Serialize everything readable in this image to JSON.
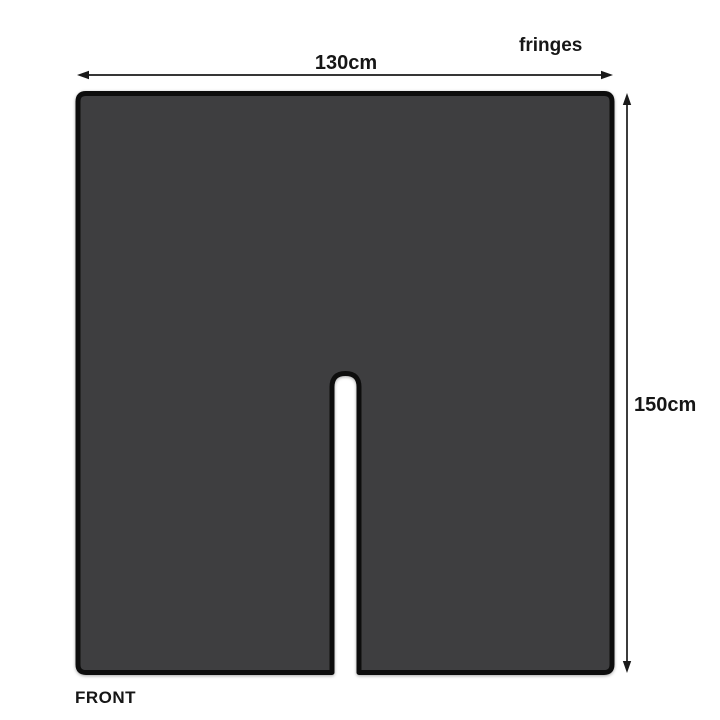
{
  "diagram": {
    "title": "fabric panel dimension diagram",
    "width_label": "130cm",
    "height_label": "150cm",
    "fringes_label": "fringes",
    "front_label": "FRONT",
    "dimensions": {
      "width_cm": 130,
      "height_cm": 150
    },
    "colors": {
      "panel_fill": "#3e3e40",
      "panel_border": "#0d0d0d",
      "arrow": "#1a1a1a",
      "background": "#ffffff",
      "text": "#161616"
    }
  }
}
